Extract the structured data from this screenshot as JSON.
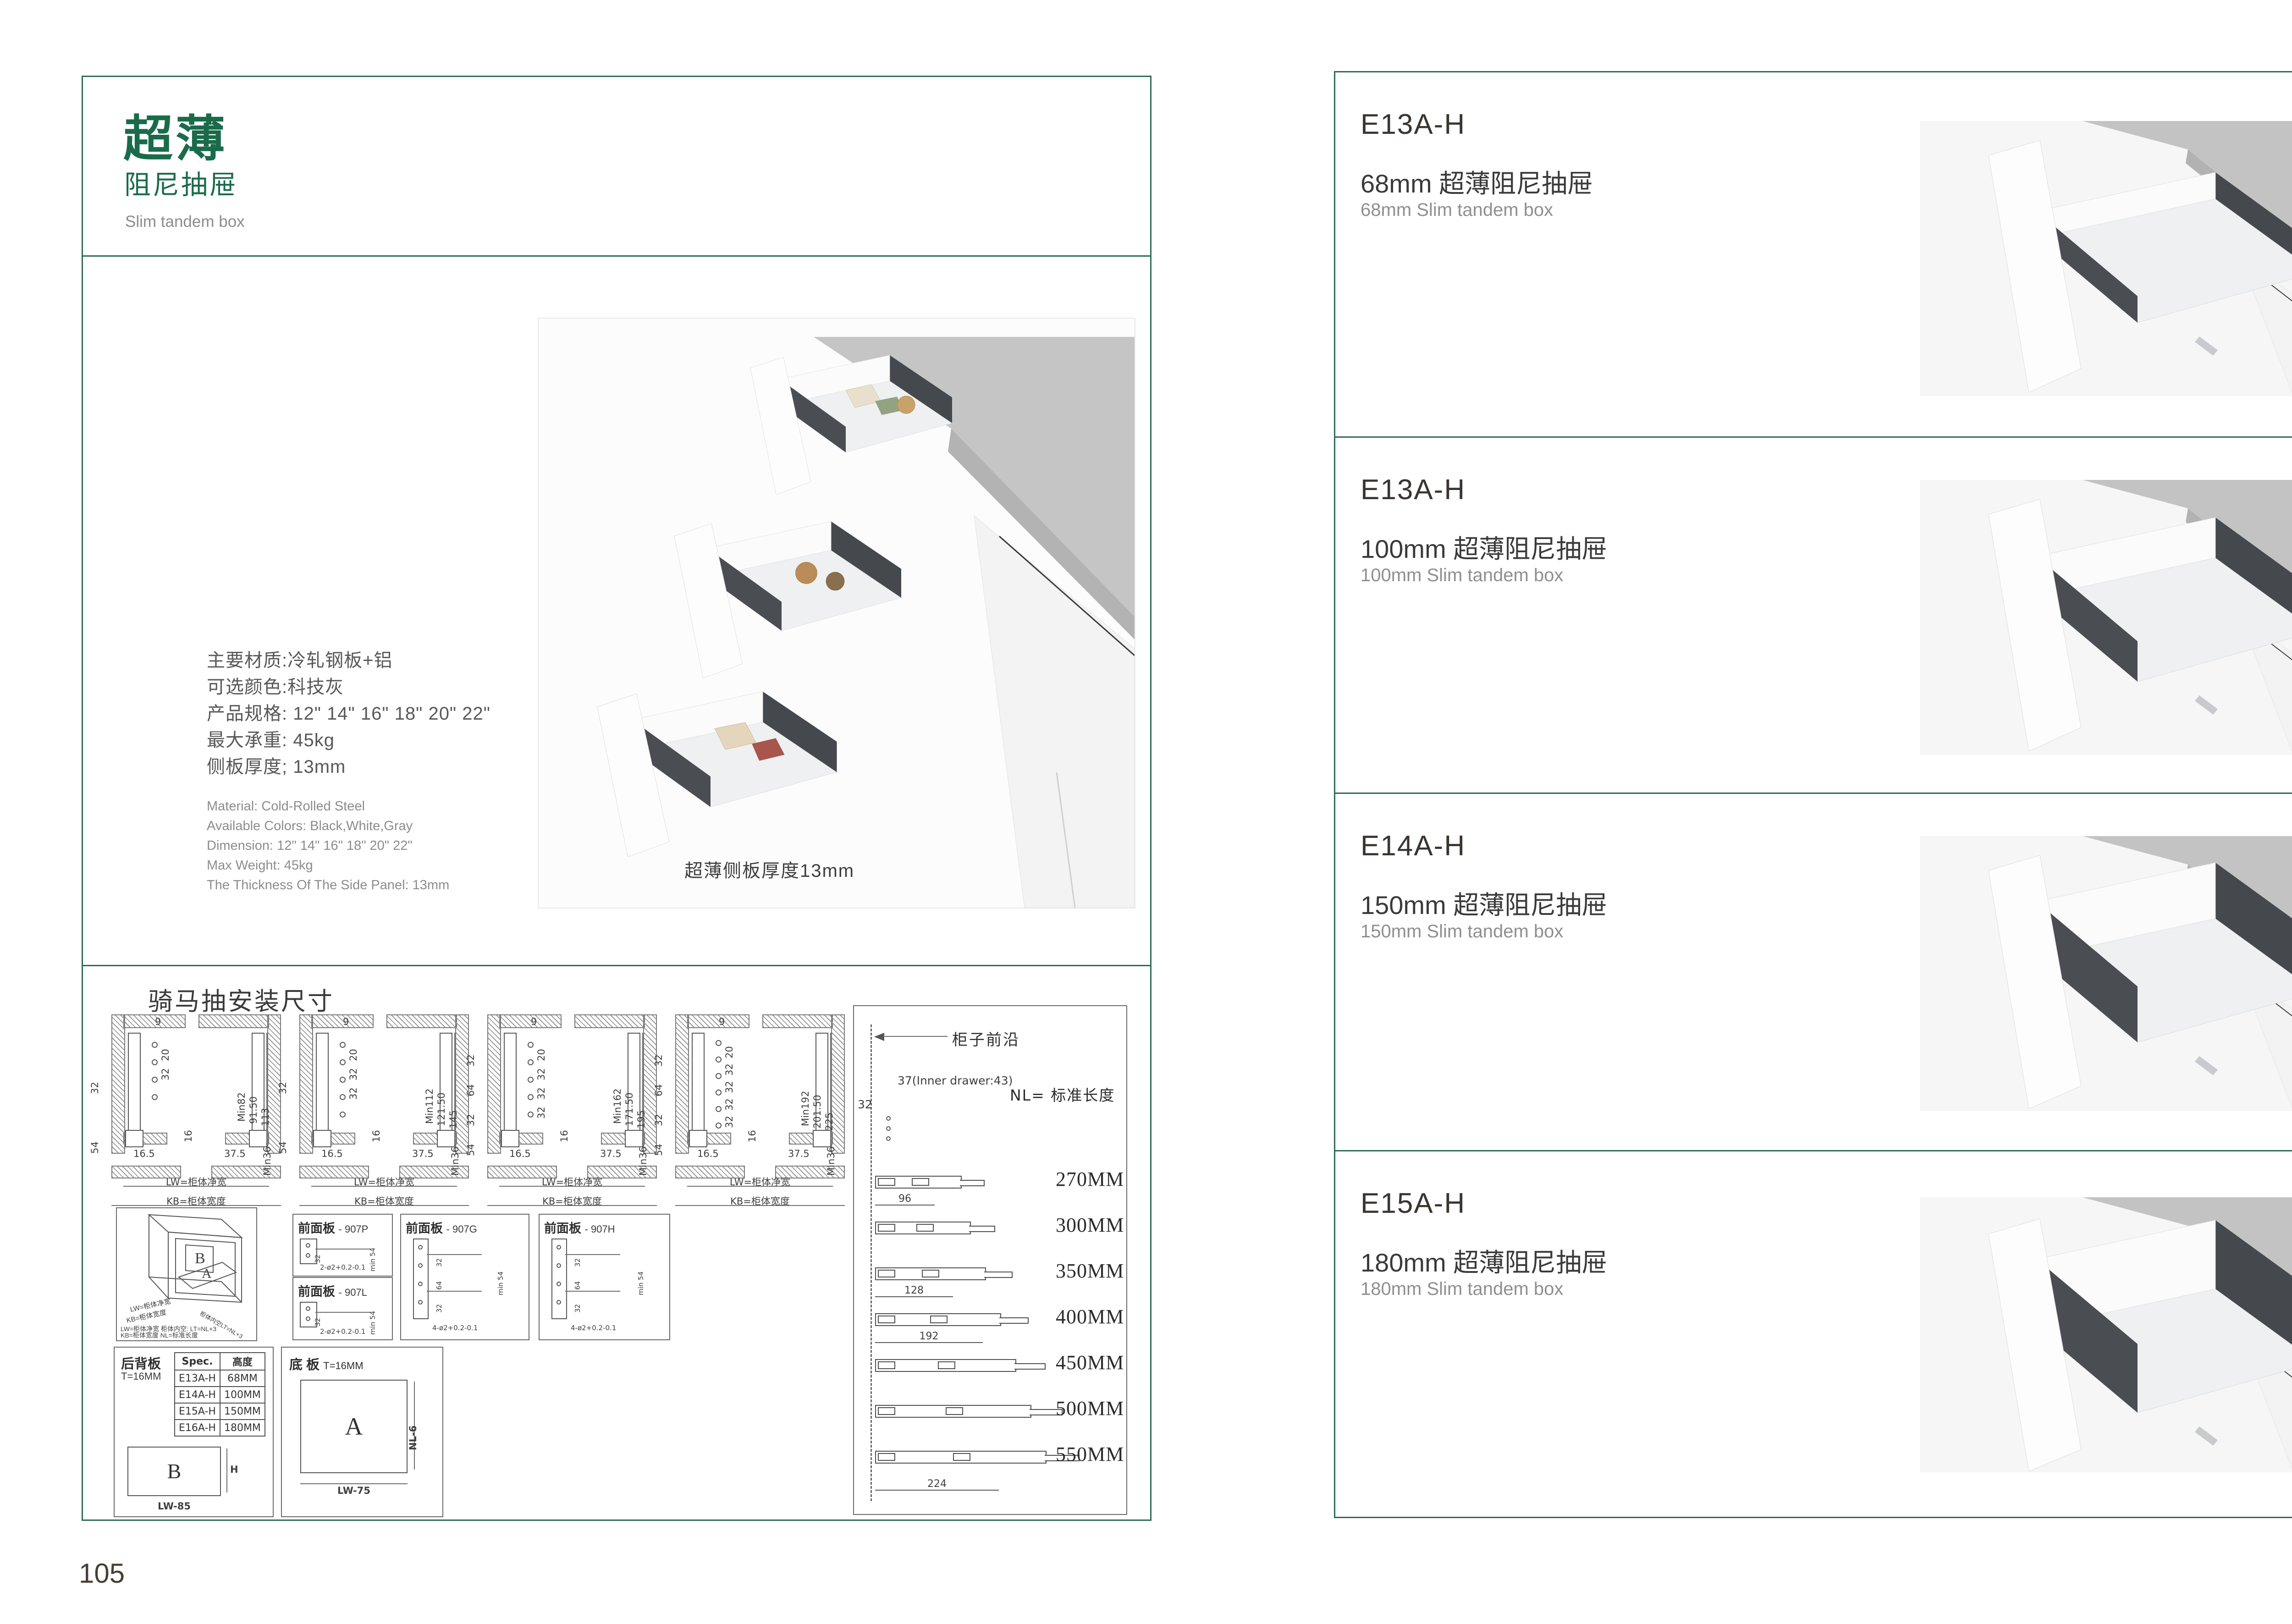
{
  "page": {
    "left_number": "105",
    "right_number": "106"
  },
  "left": {
    "title_main": "超薄",
    "title_sub": "阻尼抽屉",
    "title_en": "Slim tandem box",
    "specs_cn": [
      "主要材质:冷轧钢板+铝",
      "可选颜色:科技灰",
      "产品规格: 12\" 14\" 16\" 18\" 20\" 22\"",
      "最大承重: 45kg",
      "侧板厚度; 13mm"
    ],
    "specs_en": [
      "Material: Cold-Rolled Steel",
      "Available Colors: Black,White,Gray",
      "Dimension: 12\" 14\" 16\" 18\" 20\" 22\"",
      "Max Weight: 45kg",
      "The Thickness Of The Side Panel: 13mm"
    ],
    "photo_caption": "超薄侧板厚度13mm"
  },
  "drawings": {
    "title": "骑马抽安装尺寸",
    "xsections": [
      {
        "top": "9",
        "col": [
          "20",
          "32"
        ],
        "mid": "16",
        "left": [
          "32",
          "54"
        ],
        "right": [
          "Min82",
          "91.50",
          "113"
        ],
        "b1": "16.5",
        "b2": "37.5",
        "bmin": "Min36",
        "lw": "LW=柜体净宽",
        "kb": "KB=柜体宽度"
      },
      {
        "top": "9",
        "col": [
          "20",
          "32",
          "32"
        ],
        "mid": "16",
        "left": [
          "32",
          "54"
        ],
        "right": [
          "Min112",
          "121.50",
          "145"
        ],
        "b1": "16.5",
        "b2": "37.5",
        "bmin": "Min36",
        "lw": "LW=柜体净宽",
        "kb": "KB=柜体宽度"
      },
      {
        "top": "9",
        "col": [
          "20",
          "32",
          "32",
          "32"
        ],
        "mid": "16",
        "left": [
          "32",
          "64",
          "32",
          "54"
        ],
        "right": [
          "Min162",
          "171.50",
          "195"
        ],
        "b1": "16.5",
        "b2": "37.5",
        "bmin": "Min36",
        "lw": "LW=柜体净宽",
        "kb": "KB=柜体宽度"
      },
      {
        "top": "9",
        "col": [
          "20",
          "32",
          "32",
          "32",
          "32"
        ],
        "mid": "16",
        "left": [
          "32",
          "64",
          "32",
          "54"
        ],
        "right": [
          "Min192",
          "201.50",
          "225"
        ],
        "b1": "16.5",
        "b2": "37.5",
        "bmin": "Min36",
        "lw": "LW=柜体净宽",
        "kb": "KB=柜体宽度"
      }
    ],
    "isometric": {
      "label_a": "A",
      "label_b": "B",
      "edge_lw": "LW=柜体净宽",
      "edge_kb": "KB=柜体宽度",
      "edge_lt": "柜体内空LT=NL+3",
      "legend_line1": "LW=柜体净宽   柜体内空: LT=NL+3",
      "legend_line2": "KB=柜体宽度   NL=标准长度"
    },
    "front_panels": [
      {
        "name": "前面板",
        "code": "- 907P",
        "dim1": "32",
        "dim2": "min 54",
        "note": "2-ø2+0.2-0.1"
      },
      {
        "name": "前面板",
        "code": "- 907L",
        "dim1": "32",
        "dim2": "min 54",
        "note": "2-ø2+0.2-0.1"
      },
      {
        "name": "前面板",
        "code": "- 907G",
        "dim1": "32",
        "dim2": "64",
        "dim3": "32",
        "dim4": "min 54",
        "note": "4-ø2+0.2-0.1"
      },
      {
        "name": "前面板",
        "code": "- 907H",
        "dim1": "32",
        "dim2": "64",
        "dim3": "32",
        "dim4": "min 54",
        "note": "4-ø2+0.2-0.1"
      }
    ],
    "back_panel": {
      "title": "后背板",
      "thickness": "T=16MM",
      "table": {
        "col1": "Spec.",
        "col2": "高度",
        "rows": [
          [
            "E13A-H",
            "68MM"
          ],
          [
            "E14A-H",
            "100MM"
          ],
          [
            "E15A-H",
            "150MM"
          ],
          [
            "E16A-H",
            "180MM"
          ]
        ]
      },
      "rect_label": "B",
      "height_label": "H",
      "width_label": "LW-85"
    },
    "base_panel": {
      "title": "底 板",
      "thickness": "T=16MM",
      "rect_label": "A",
      "depth_label": "NL-6",
      "width_label": "LW-75"
    },
    "nl_panel": {
      "front_edge": "柜子前沿",
      "inner_note": "37(Inner drawer:43)",
      "pitch": "32",
      "nl_eq": "NL= 标准长度",
      "sizes": [
        "270MM",
        "300MM",
        "350MM",
        "400MM",
        "450MM",
        "500MM",
        "550MM"
      ],
      "dims": [
        "96",
        "128",
        "192",
        "224"
      ]
    }
  },
  "right": {
    "products": [
      {
        "model": "E13A-H",
        "title_cn": "68mm 超薄阻尼抽屉",
        "title_en": "68mm Slim tandem box"
      },
      {
        "model": "E13A-H",
        "title_cn": "100mm 超薄阻尼抽屉",
        "title_en": "100mm Slim tandem box"
      },
      {
        "model": "E14A-H",
        "title_cn": "150mm 超薄阻尼抽屉",
        "title_en": "150mm Slim tandem box"
      },
      {
        "model": "E15A-H",
        "title_cn": "180mm 超薄阻尼抽屉",
        "title_en": "180mm Slim tandem box"
      }
    ]
  }
}
